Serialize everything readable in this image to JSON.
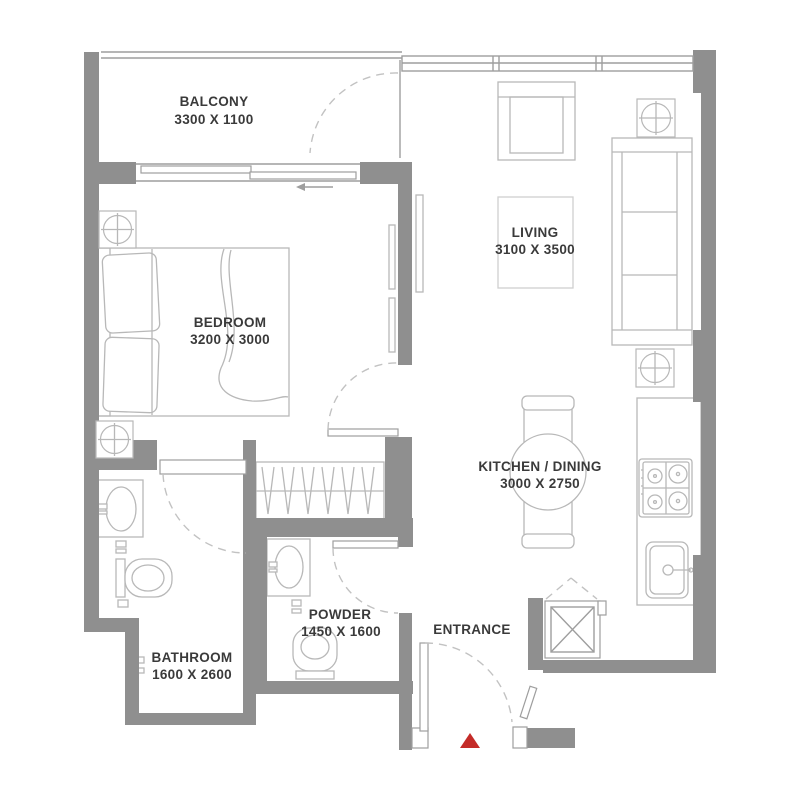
{
  "plan": {
    "type": "apartment-floor-plan",
    "rooms": {
      "balcony": {
        "label": "BALCONY",
        "dims": "3300 X 1100"
      },
      "living": {
        "label": "LIVING",
        "dims": "3100 X 3500"
      },
      "bedroom": {
        "label": "BEDROOM",
        "dims": "3200 X 3000"
      },
      "kitchen_dining": {
        "label": "KITCHEN / DINING",
        "dims": "3000 X 2750"
      },
      "bathroom": {
        "label": "BATHROOM",
        "dims": "1600 X 2600"
      },
      "powder": {
        "label": "POWDER",
        "dims": "1450 X 1600"
      },
      "entrance": {
        "label": "ENTRANCE"
      }
    },
    "colors": {
      "wall": "#8f8f8f",
      "line": "#9e9e9e",
      "furn": "#b8b8b8",
      "dashline": "#c2c2c2",
      "text": "#3a3a3a",
      "marker": "#c42b28",
      "background": "#ffffff"
    }
  }
}
